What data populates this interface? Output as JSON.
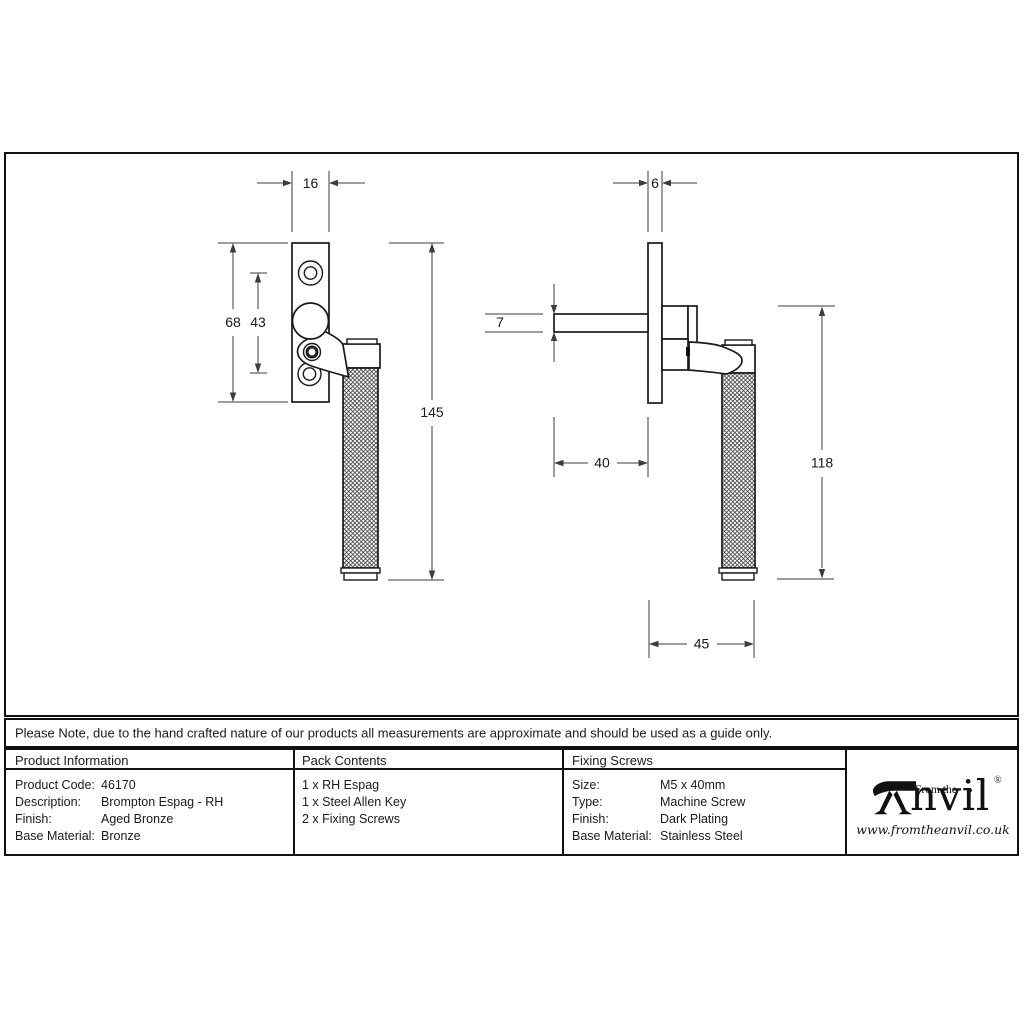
{
  "note": "Please Note, due to the hand crafted nature of our products all measurements are approximate and should be used as a guide only.",
  "dims": {
    "front": {
      "plate_width": "16",
      "plate_height": "68",
      "hole_spacing": "43",
      "overall_height": "145"
    },
    "side": {
      "plate_thickness": "6",
      "spindle_thickness": "7",
      "spindle_length": "40",
      "drop_height": "118",
      "projection": "45"
    }
  },
  "table": {
    "product_information": {
      "header": "Product Information",
      "rows": [
        {
          "label": "Product Code:",
          "value": "46170"
        },
        {
          "label": "Description:",
          "value": "Brompton Espag - RH"
        },
        {
          "label": "Finish:",
          "value": "Aged Bronze"
        },
        {
          "label": "Base Material:",
          "value": "Bronze"
        }
      ]
    },
    "pack_contents": {
      "header": "Pack Contents",
      "items": [
        "1 x RH Espag",
        "1 x Steel Allen Key",
        "2 x Fixing Screws"
      ]
    },
    "fixing_screws": {
      "header": "Fixing Screws",
      "rows": [
        {
          "label": "Size:",
          "value": "M5 x 40mm"
        },
        {
          "label": "Type:",
          "value": "Machine Screw"
        },
        {
          "label": "Finish:",
          "value": "Dark Plating"
        },
        {
          "label": "Base Material:",
          "value": "Stainless Steel"
        }
      ]
    }
  },
  "logo": {
    "tagline": "From the",
    "diamond": "♦",
    "name_rest": "nvil",
    "registered": "®",
    "website": "www.fromtheanvil.co.uk"
  },
  "colors": {
    "ink": "#1a1a1a",
    "background": "#ffffff"
  }
}
